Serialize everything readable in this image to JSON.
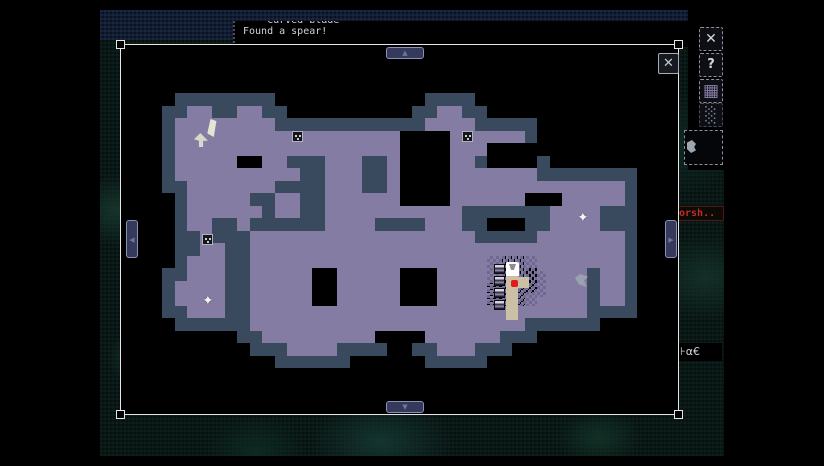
{
  "log": {
    "line1": "*** Curved blade ****",
    "line2": "Found a spear!"
  },
  "map_window": {
    "close_glyph": "✕",
    "scroll": {
      "up": "▲",
      "down": "▼",
      "left": "◀",
      "right": "▶"
    }
  },
  "map": {
    "legend": {
      "o": "explored floor",
      "x": "unexplored hole",
      "#": "wall",
      "d": "dithered floor",
      ".": "empty, becomes wall outline next to floor"
    },
    "tile_size": 12.5,
    "origin": {
      "x": 162,
      "y": 93
    },
    "colors": {
      "floor": "#847CA2",
      "wall": "#3A4A5E",
      "hole": "#000000",
      "highlight_path": "#C9C0A6",
      "player_dot": "#E31A15",
      "window_border": "#E6E6E6",
      "button_fill": "#353A5C",
      "button_border": "#8A90B4"
    },
    "grid": [
      "..##..##..............##..............",
      "..oo..oo..............oo..............",
      ".oooooooo............oooo.............",
      ".ooooooooooooooooooxxxxoooooo.........",
      ".ooooooooooooooooooxxxxoooxxxx........",
      ".oooooxxoo...ooo..oxxxxoo.xxxx........",
      ".oooooooooo..ooo..oxxxxooooooo........",
      "..ooooooo....ooo..oxxxxoooooooooooooo.",
      "..ooooo..oo..ooooooxxxxooooooxxxooooo.",
      "..oooooo.oo..ooooooooooo.......oooo...",
      "..oo..o......oooo....ooo.......oooo...",
      "...o...oooooooooooooooooo.....ooooooo.",
      "...oo..oooooooooooooooooooooooooooooo.",
      "..ooo..ooooooooooooooooooodddoooooooo.",
      "..ooo..oooooxxoooooxxxooooddddoooo.oo.",
      ".oooo..oooooxxoooooxxxooooddddoooo.oo.",
      ".oooo..oooooxxoooooxxxoooodddooooo.oo.",
      "..ooo..ooooooooooooooooooooooooooo....",
      ".......oooooooooooooooooooooo.........",
      "........oooooooooxxxxoooooo...........",
      "..........oooo........ooo.............",
      "......................................"
    ],
    "markers": [
      {
        "type": "dither",
        "x": 487,
        "y": 256,
        "w": 50,
        "h": 50
      },
      {
        "type": "dither",
        "x": 537,
        "y": 271,
        "w": 9,
        "h": 26
      },
      {
        "type": "path",
        "x": 506,
        "y": 263,
        "w": 12,
        "h": 57
      },
      {
        "type": "path",
        "x": 518,
        "y": 277,
        "w": 11,
        "h": 11
      },
      {
        "type": "item-blade",
        "x": 204,
        "y": 118
      },
      {
        "type": "item-pick",
        "x": 193,
        "y": 132
      },
      {
        "type": "chest",
        "x": 292,
        "y": 131
      },
      {
        "type": "chest",
        "x": 462,
        "y": 131
      },
      {
        "type": "chest",
        "x": 202,
        "y": 234
      },
      {
        "type": "waypoint-plus",
        "x": 577,
        "y": 211,
        "glyph": "✦"
      },
      {
        "type": "waypoint-plus",
        "x": 202,
        "y": 294,
        "glyph": "✦"
      },
      {
        "type": "creature",
        "x": 575,
        "y": 274
      },
      {
        "type": "door-box",
        "x": 494,
        "y": 264
      },
      {
        "type": "door-box",
        "x": 494,
        "y": 276
      },
      {
        "type": "door-box",
        "x": 494,
        "y": 288
      },
      {
        "type": "door-box",
        "x": 494,
        "y": 300
      },
      {
        "type": "player-marker",
        "x": 506,
        "y": 262
      },
      {
        "type": "player-dot",
        "x": 511,
        "y": 280
      }
    ]
  },
  "side_panel": {
    "buttons": [
      {
        "name": "marker-diamond-button",
        "glyph": "✕"
      },
      {
        "name": "help-button",
        "glyph": "?"
      },
      {
        "name": "grid-solid-button",
        "glyph": "▦"
      },
      {
        "name": "grid-dotted-button",
        "glyph": "░"
      }
    ],
    "location_label": "orsh..",
    "status_glyphs": "⊦α€"
  }
}
